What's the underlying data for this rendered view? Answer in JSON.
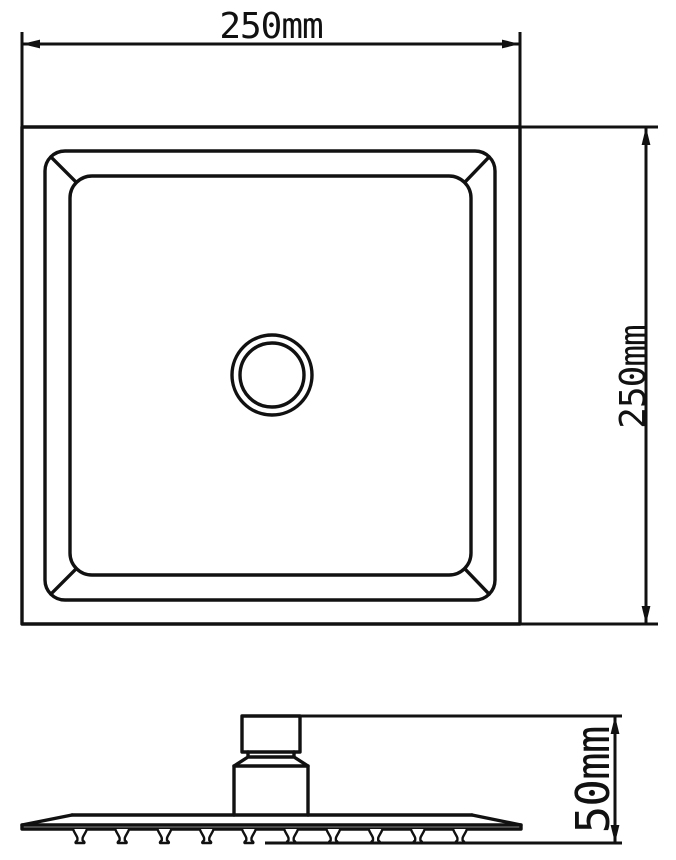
{
  "colors": {
    "background": "#ffffff",
    "line": "#111111"
  },
  "views": {
    "top": {
      "width_label": "250mm",
      "height_label": "250mm"
    },
    "side": {
      "height_label": "50mm"
    }
  }
}
